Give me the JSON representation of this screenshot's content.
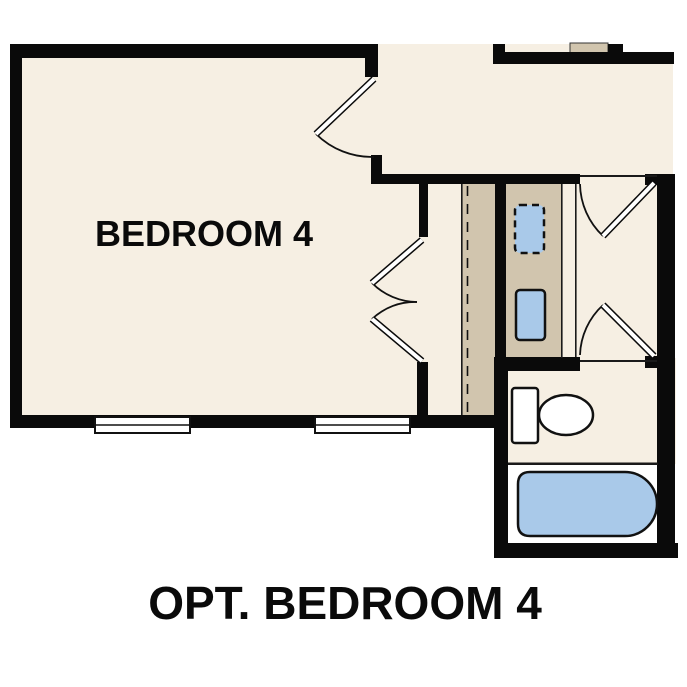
{
  "page": {
    "background": "#ffffff"
  },
  "plan": {
    "room_label": "BEDROOM 4",
    "caption": "OPT. BEDROOM 4",
    "colors": {
      "floor_cream": "#f6efe3",
      "millwork_tan": "#d1c5ae",
      "fixture_blue": "#a9c9e9",
      "wall_black": "#0a0a0a",
      "tub_room_floor_white": "#ffffff"
    },
    "fixtures": [
      {
        "name": "toilet"
      },
      {
        "name": "bathtub"
      },
      {
        "name": "sink"
      },
      {
        "name": "optional-sink-dashed"
      }
    ],
    "features": {
      "windows": 2,
      "swing_doors": 5,
      "dashed_chase_line": 1
    }
  }
}
